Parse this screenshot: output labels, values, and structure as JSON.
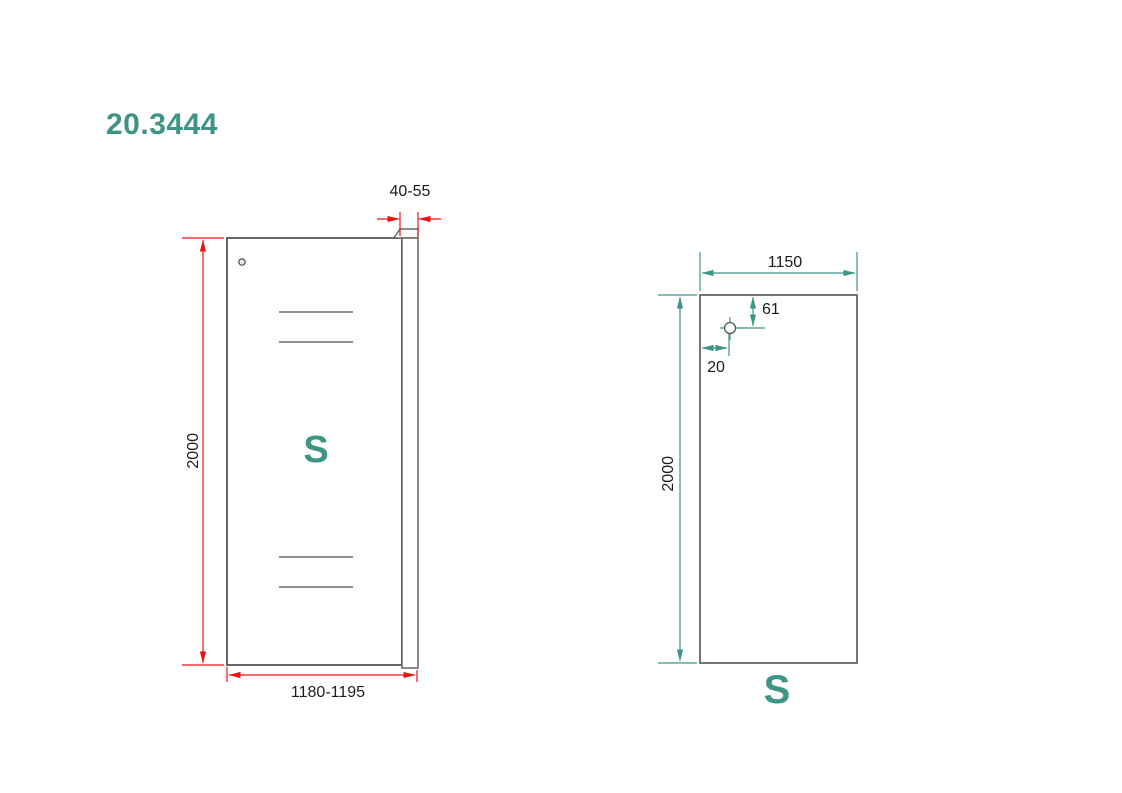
{
  "title": "20.3444",
  "colors": {
    "accent_teal": "#3E9486",
    "dimension_red": "#EE1111",
    "outline_gray": "#666666",
    "reflection_gray": "#8F8F8F"
  },
  "front_view": {
    "label": "S",
    "dims": {
      "profile_depth": "40-55",
      "height": "2000",
      "width": "1180-1195"
    }
  },
  "side_view": {
    "label": "S",
    "dims": {
      "width": "1150",
      "height": "2000",
      "hole_from_top": "61",
      "hole_from_edge": "20"
    }
  }
}
